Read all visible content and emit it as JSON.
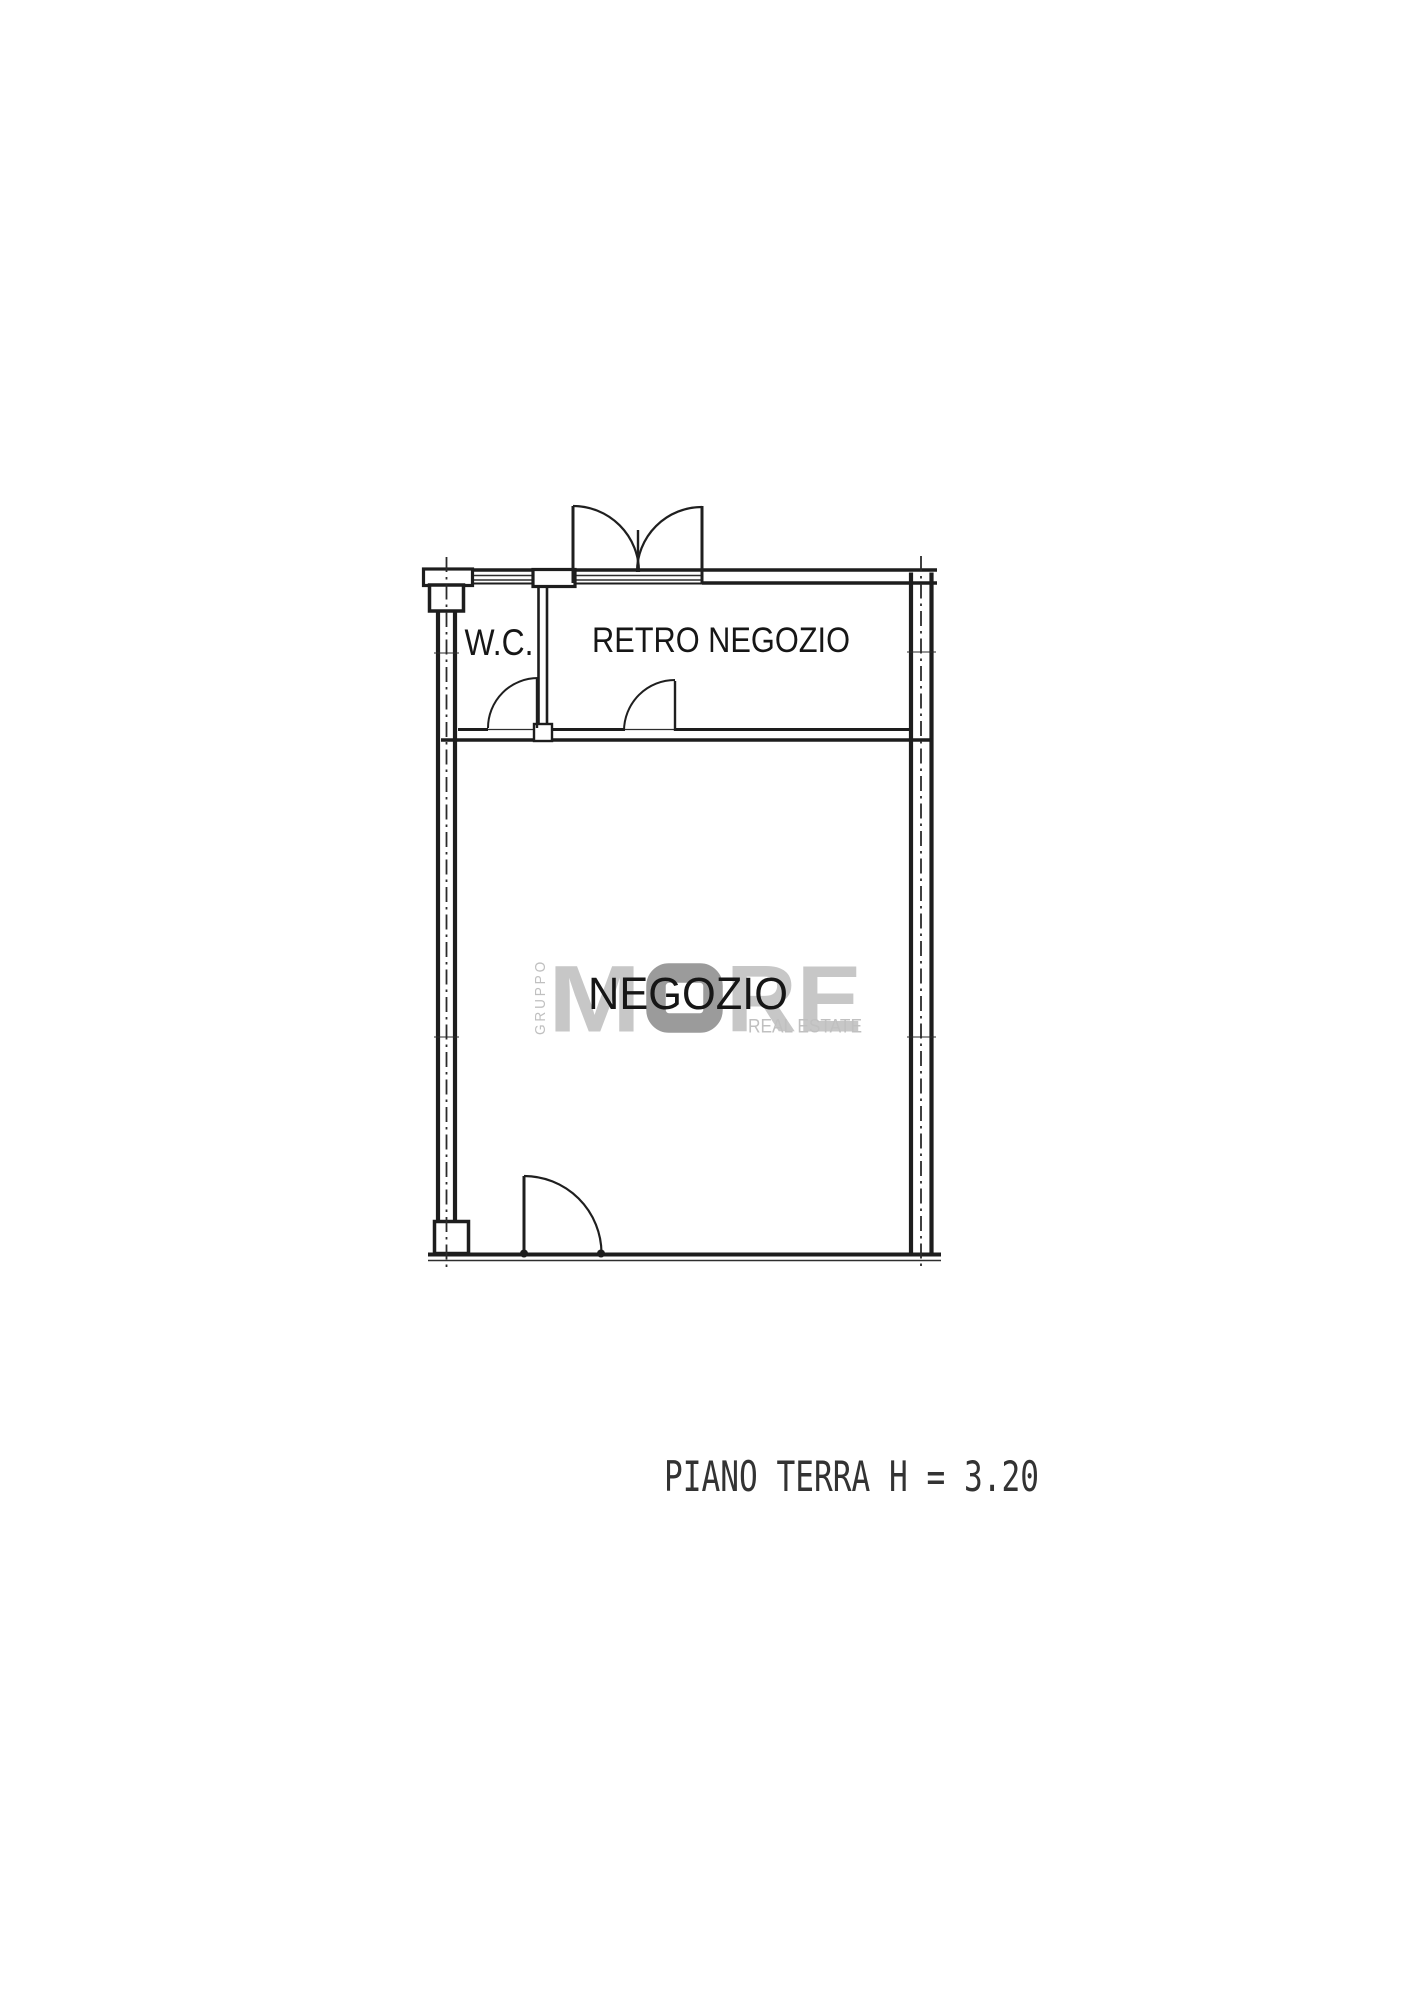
{
  "page": {
    "background": "#ffffff"
  },
  "plan": {
    "line_color": "#1d1d1d",
    "rooms": {
      "wc": {
        "label": "W.C."
      },
      "retro_negozio": {
        "label": "RETRO NEGOZIO"
      },
      "negozio": {
        "label": "NEGOZIO"
      }
    },
    "caption": "PIANO TERRA H = 3.20"
  },
  "watermark": {
    "vertical_text": "GRUPPO",
    "brand_letter_m": "M",
    "brand_mark": "O",
    "brand_letters_re": "RE",
    "tagline": "REAL ESTATE",
    "light_gray": "#c7c7c7",
    "mark_gray": "#9b9b9b"
  }
}
